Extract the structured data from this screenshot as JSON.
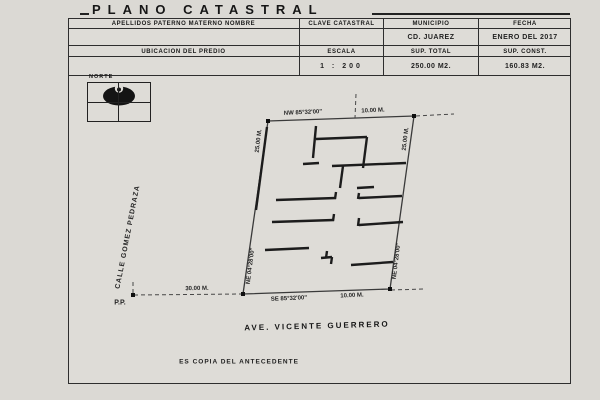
{
  "title": "PLANO CATASTRAL",
  "form": {
    "row1": [
      {
        "label": "APELLIDOS PATERNO  MATERNO  NOMBRE",
        "value": ""
      },
      {
        "label": "CLAVE CATASTRAL",
        "value": ""
      },
      {
        "label": "MUNICIPIO",
        "value": "CD. JUAREZ"
      },
      {
        "label": "FECHA",
        "value": "ENERO DEL 2017"
      }
    ],
    "row2": [
      {
        "label": "UBICACION DEL PREDIO",
        "value": ""
      },
      {
        "label": "ESCALA",
        "value": "1 : 200"
      },
      {
        "label": "SUP. TOTAL",
        "value": "250.00 M2."
      },
      {
        "label": "SUP. CONST.",
        "value": "160.83 M2."
      }
    ]
  },
  "compass": {
    "label": "NORTE"
  },
  "plot": {
    "bearing_top": "NW 85°32'00\"",
    "length_top": "10.00 M.",
    "length_left": "25.00 M.",
    "length_right": "25.00 M.",
    "bearing_bottom": "SE 85°32'00\"",
    "length_bottom": "10.00 M.",
    "bearing_side_left": "NE 04°28'00\"",
    "bearing_side_right": "NE 04°28'00\"",
    "offset_length": "30.00 M.",
    "pp_label": "P.P."
  },
  "streets": {
    "left": "CALLE GOMEZ PEDRAZA",
    "bottom": "AVE. VICENTE GUERRERO"
  },
  "note": "ES COPIA DEL ANTECEDENTE",
  "colors": {
    "paper": "#dedcd7",
    "ink": "#1c1c1c"
  },
  "drawing": {
    "boundary": [
      [
        268,
        121
      ],
      [
        414,
        116
      ],
      [
        390,
        289
      ],
      [
        243,
        294
      ]
    ],
    "walls": [
      [
        267,
        127,
        256,
        210
      ],
      [
        316,
        126,
        313,
        158
      ],
      [
        316,
        139,
        367,
        137
      ],
      [
        367,
        137,
        363,
        168
      ],
      [
        303,
        164,
        319,
        163
      ],
      [
        332,
        166,
        406,
        163
      ],
      [
        343,
        166,
        340,
        188
      ],
      [
        357,
        188,
        374,
        187
      ],
      [
        359,
        193,
        358,
        199
      ],
      [
        359,
        198,
        402,
        196
      ],
      [
        276,
        200,
        336,
        198
      ],
      [
        336,
        192,
        335,
        199
      ],
      [
        272,
        222,
        334,
        220
      ],
      [
        334,
        214,
        333,
        221
      ],
      [
        359,
        218,
        358,
        226
      ],
      [
        359,
        225,
        403,
        222
      ],
      [
        265,
        250,
        309,
        248
      ],
      [
        327,
        251,
        326,
        258
      ],
      [
        321,
        258,
        332,
        257
      ],
      [
        332,
        257,
        331,
        264
      ],
      [
        351,
        265,
        393,
        262
      ]
    ],
    "dashes": [
      [
        356,
        94,
        355,
        118
      ],
      [
        134,
        295,
        242,
        294
      ],
      [
        416,
        116,
        454,
        114
      ],
      [
        391,
        290,
        424,
        289
      ],
      [
        133,
        282,
        133,
        294
      ]
    ],
    "markers": [
      [
        268,
        121
      ],
      [
        414,
        116
      ],
      [
        390,
        289
      ],
      [
        243,
        294
      ],
      [
        133,
        295
      ]
    ]
  }
}
